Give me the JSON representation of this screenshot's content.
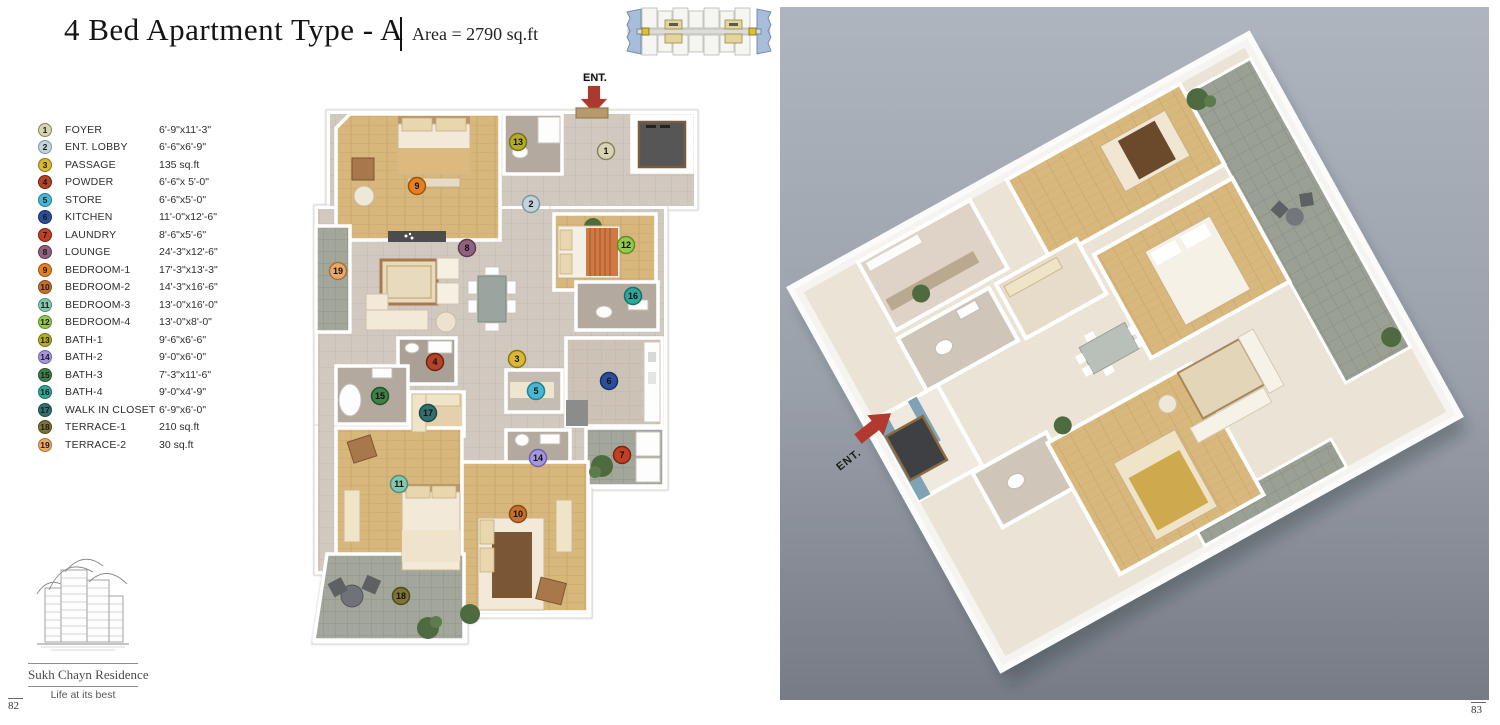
{
  "page": {
    "title": "4 Bed Apartment Type - A",
    "area_label": "Area = 2790 sq.ft",
    "page_number_left": "82",
    "page_number_right": "83"
  },
  "brand": {
    "name": "Sukh Chayn Residence",
    "tagline": "Life at its best"
  },
  "entrance": {
    "label_2d": "ENT.",
    "label_3d": "ENT.",
    "arrow_color": "#ab3a2e"
  },
  "legend": {
    "items": [
      {
        "num": "1",
        "name": "FOYER",
        "dim": "6'-9\"x11'-3\"",
        "color": "#d8d4b2",
        "border": "#84845e"
      },
      {
        "num": "2",
        "name": "ENT. LOBBY",
        "dim": "6'-6\"x6'-9\"",
        "color": "#c3d3da",
        "border": "#7d97a2"
      },
      {
        "num": "3",
        "name": "PASSAGE",
        "dim": "135 sq.ft",
        "color": "#d9b931",
        "border": "#8a7414"
      },
      {
        "num": "4",
        "name": "POWDER",
        "dim": "6'-6\"x 5'-0\"",
        "color": "#b5432a",
        "border": "#6e2312"
      },
      {
        "num": "5",
        "name": "STORE",
        "dim": "6'-6\"x5'-0\"",
        "color": "#47b7d2",
        "border": "#1f7f99"
      },
      {
        "num": "6",
        "name": "KITCHEN",
        "dim": "11'-0\"x12'-6\"",
        "color": "#2c4e9a",
        "border": "#16306b"
      },
      {
        "num": "7",
        "name": "LAUNDRY",
        "dim": "8'-6\"x5'-6\"",
        "color": "#c23f24",
        "border": "#7a2310"
      },
      {
        "num": "8",
        "name": "LOUNGE",
        "dim": "24'-3\"x12'-6\"",
        "color": "#91627f",
        "border": "#5c3a50"
      },
      {
        "num": "9",
        "name": "BEDROOM-1",
        "dim": "17'-3\"x13'-3\"",
        "color": "#e4801f",
        "border": "#9c540f"
      },
      {
        "num": "10",
        "name": "BEDROOM-2",
        "dim": "14'-3\"x16'-6\"",
        "color": "#c76f2d",
        "border": "#8a4a15"
      },
      {
        "num": "11",
        "name": "BEDROOM-3",
        "dim": "13'-0\"x16'-0\"",
        "color": "#85c6ae",
        "border": "#4e8f7a"
      },
      {
        "num": "12",
        "name": "BEDROOM-4",
        "dim": "13'-0\"x8'-0\"",
        "color": "#94c94e",
        "border": "#5f8c28"
      },
      {
        "num": "13",
        "name": "BATH-1",
        "dim": "9'-6\"x6'-6\"",
        "color": "#b3ab2a",
        "border": "#767114"
      },
      {
        "num": "14",
        "name": "BATH-2",
        "dim": "9'-0\"x6'-0\"",
        "color": "#a596dc",
        "border": "#6f5fae"
      },
      {
        "num": "15",
        "name": "BATH-3",
        "dim": "7'-3\"x11'-6\"",
        "color": "#3f7f48",
        "border": "#235229"
      },
      {
        "num": "16",
        "name": "BATH-4",
        "dim": "9'-0\"x4'-9\"",
        "color": "#2fa89b",
        "border": "#1a6e65"
      },
      {
        "num": "17",
        "name": "WALK IN CLOSET",
        "dim": "6'-9\"x6'-0\"",
        "color": "#31706e",
        "border": "#1c4a49"
      },
      {
        "num": "18",
        "name": "TERRACE-1",
        "dim": "210 sq.ft",
        "color": "#7c7434",
        "border": "#4e481c"
      },
      {
        "num": "19",
        "name": "TERRACE-2",
        "dim": "30 sq.ft",
        "color": "#eaa968",
        "border": "#a9713a"
      }
    ]
  },
  "colors": {
    "wood": "#d8b77c",
    "tile": "#d1c9c0",
    "bath": "#b3a99f",
    "terrace": "#a2a69b",
    "kitchen": "#cdc2b6",
    "wall": "#ffffff",
    "elevator": "#565656",
    "panel_top": "#aeb5bf",
    "panel_bottom": "#767b85"
  }
}
